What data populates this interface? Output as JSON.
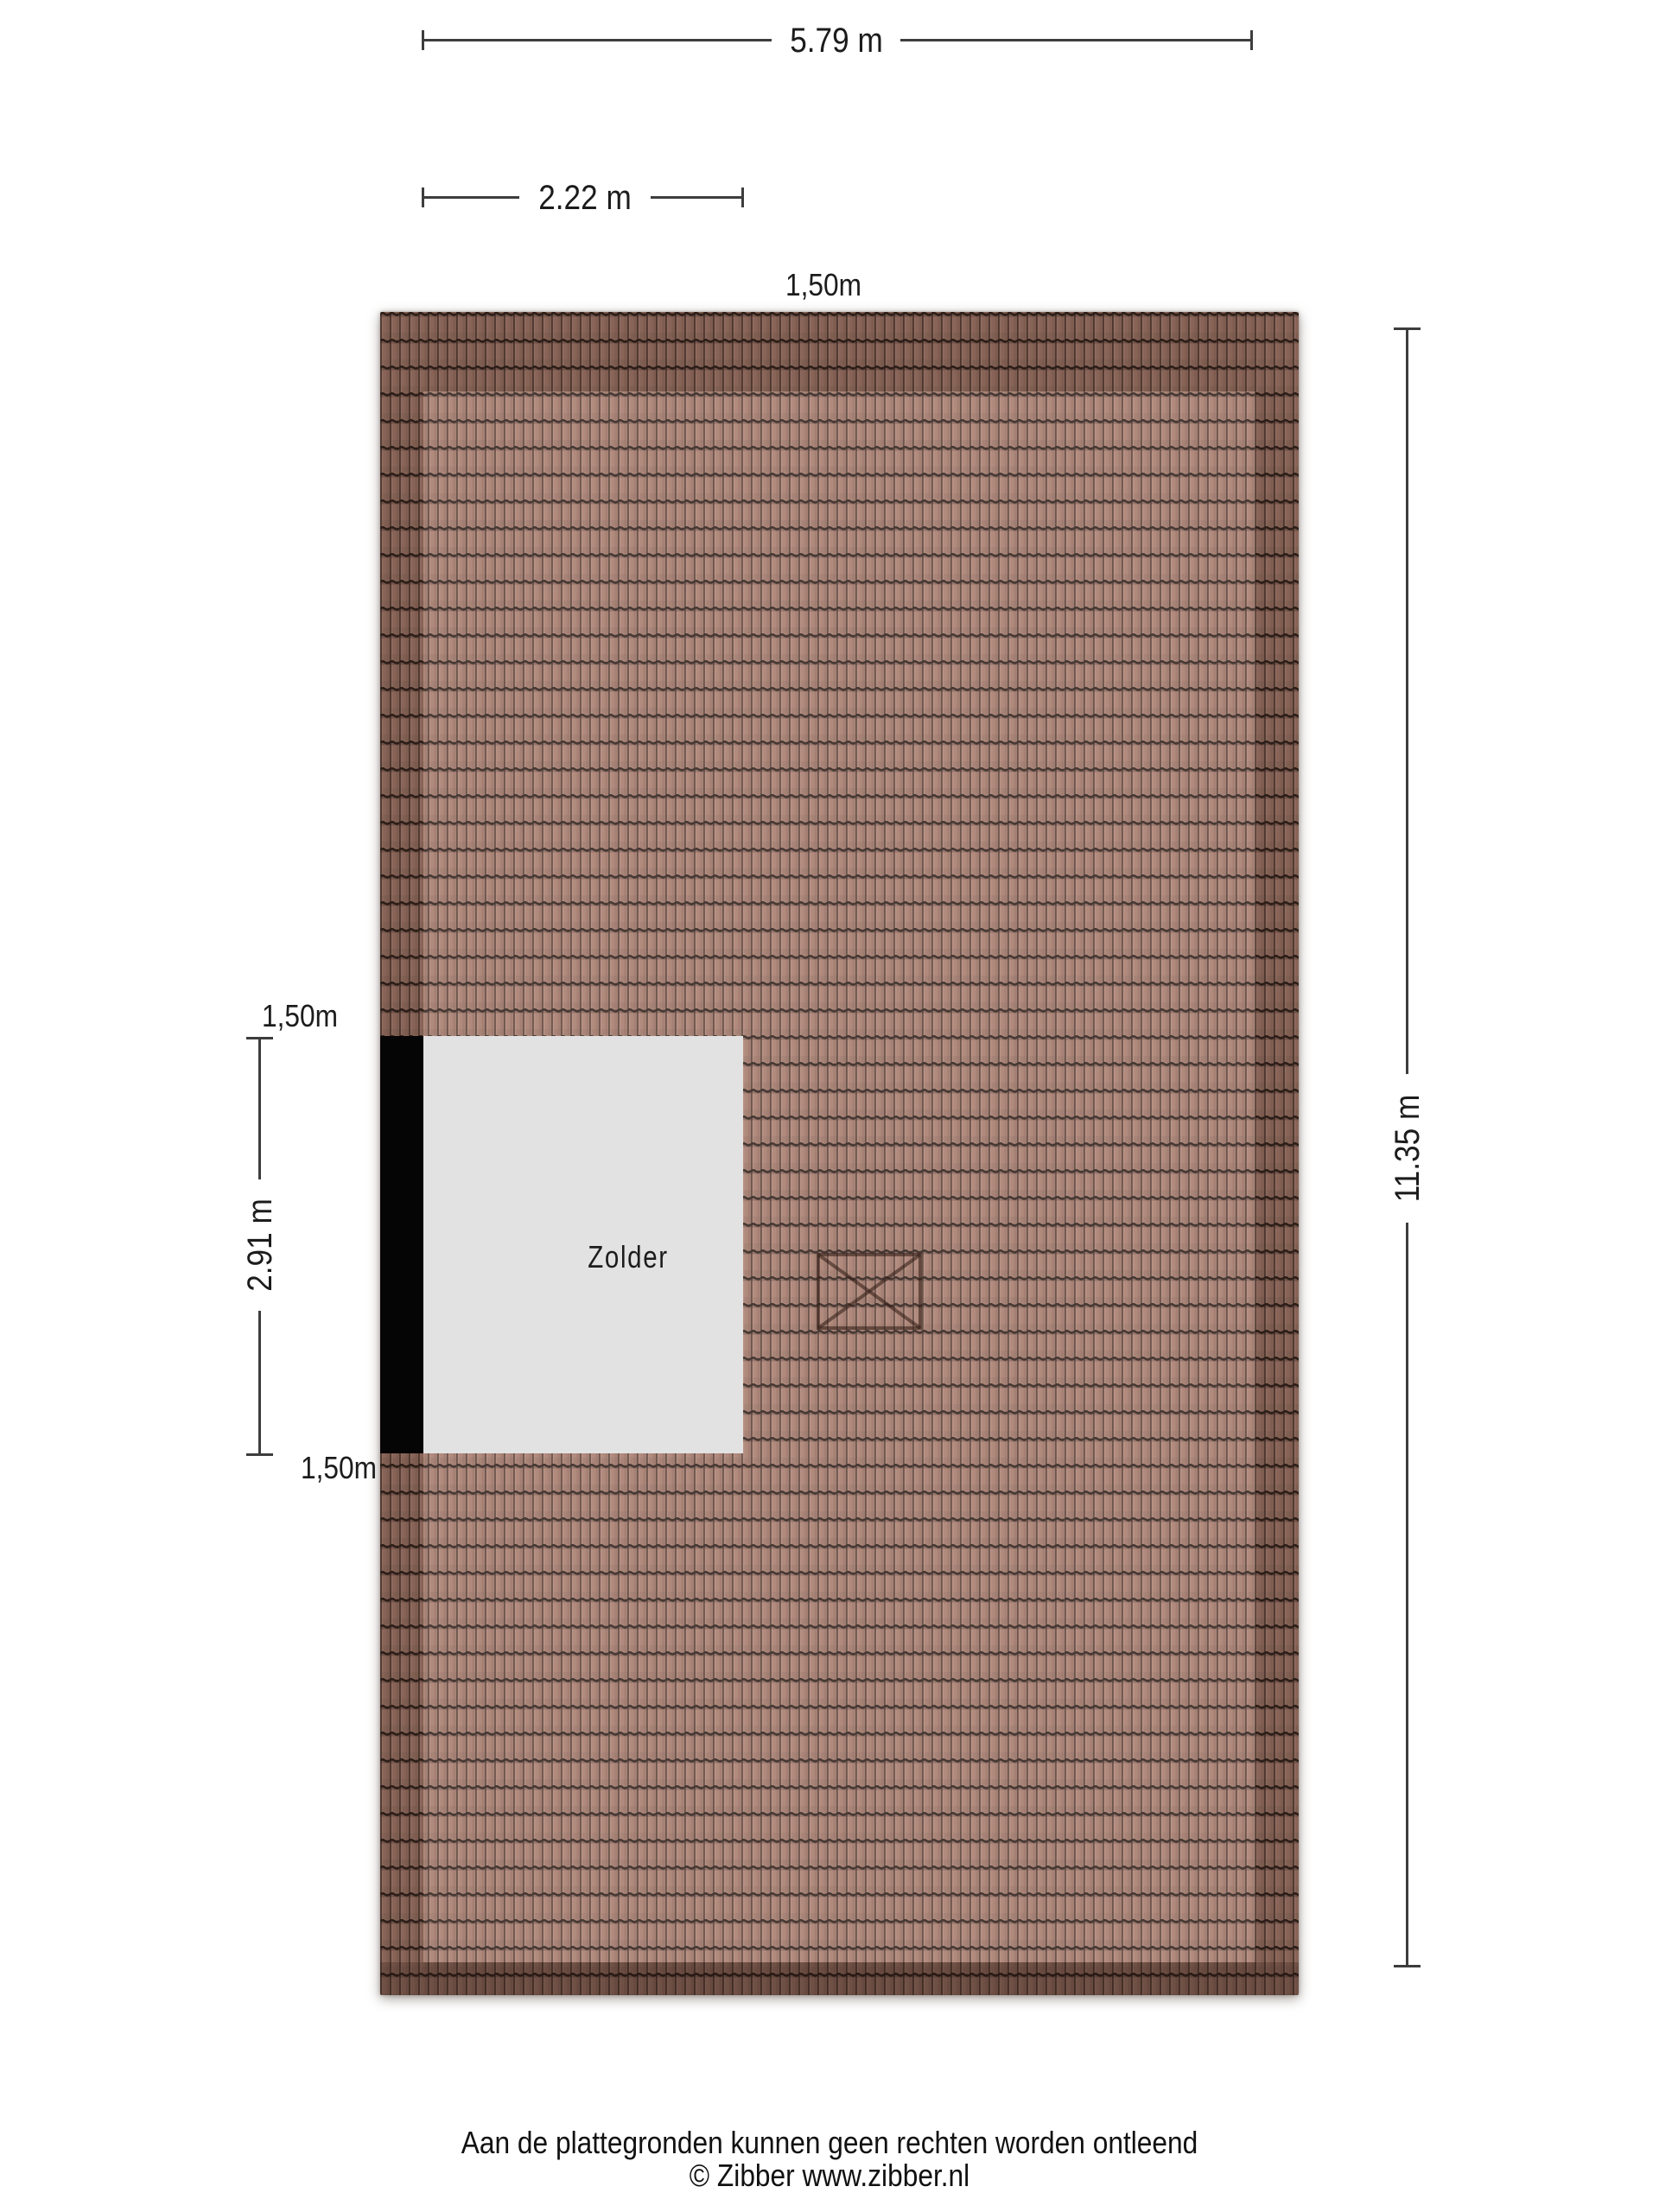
{
  "floorplan": {
    "room_label": "Zolder",
    "dimensions": {
      "top_width": "5.79 m",
      "room_width": "2.22 m",
      "headroom_top": "1,50m",
      "room_depth": "2.91 m",
      "headroom_left_top": "1,50m",
      "headroom_left_bottom": "1,50m",
      "total_height": "11.35 m"
    },
    "icons": {
      "roof_window": "roof-window-x-box"
    },
    "footer": {
      "disclaimer": "Aan de plattegronden kunnen geen rechten worden ontleend",
      "copyright": "© Zibber www.zibber.nl"
    },
    "colors": {
      "page-bg": "#ffffff",
      "tile-base": "#a87d6f",
      "wall": "#050505",
      "room-fill": "#e2e2e2",
      "dim-line": "#3d3d3d",
      "dim-text": "#1c1c1c"
    }
  }
}
